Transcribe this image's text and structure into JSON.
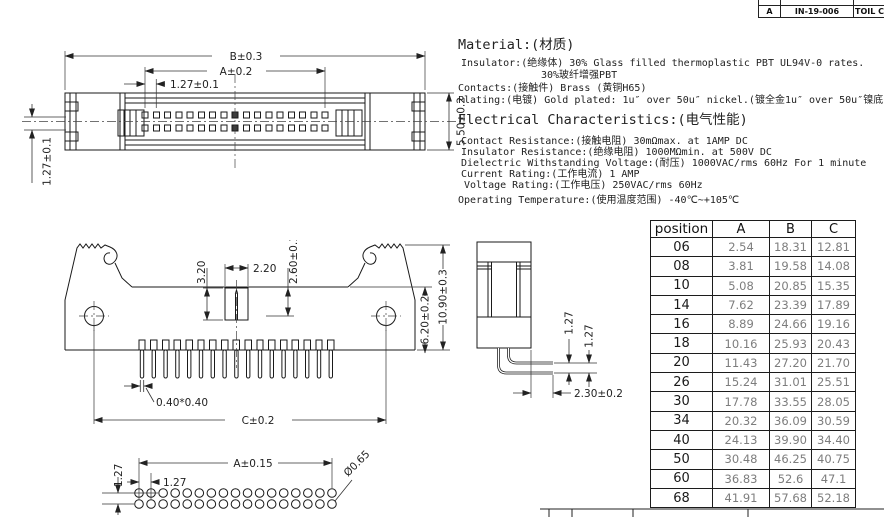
{
  "revision_strip": {
    "rev": "A",
    "code": "IN-19-006",
    "title": "TOIL C"
  },
  "material": {
    "heading": "Material:(材质)",
    "lines": [
      "Insulator:(绝缘体) 30% Glass filled thermoplastic PBT UL94V-0 rates.",
      "30%玻纤增强PBT",
      "Contacts:(接触件) Brass (黄铜H65)",
      "Plating:(电镀) Gold plated: 1u″ over 50u″ nickel.(镀全金1u″ over 50u″镍底)"
    ]
  },
  "electrical": {
    "heading": "Electrical Characteristics:(电气性能)",
    "lines": [
      "Contact Resistance:(接触电阻) 30mΩmax. at 1AMP DC",
      "Insulator Resistance:(绝缘电阻) 1000MΩmin. at 500V DC",
      "Dielectric Withstanding Voltage:(耐压) 1000VAC/rms 60Hz For 1 minute",
      "Current Rating:(工作电流) 1 AMP",
      "Voltage Rating:(工作电压) 250VAC/rms 60Hz",
      "Operating Temperature:(使用温度范围) -40℃~+105℃"
    ]
  },
  "dim_table": {
    "headers": [
      "position",
      "A",
      "B",
      "C"
    ],
    "rows": [
      [
        "06",
        "2.54",
        "18.31",
        "12.81"
      ],
      [
        "08",
        "3.81",
        "19.58",
        "14.08"
      ],
      [
        "10",
        "5.08",
        "20.85",
        "15.35"
      ],
      [
        "14",
        "7.62",
        "23.39",
        "17.89"
      ],
      [
        "16",
        "8.89",
        "24.66",
        "19.16"
      ],
      [
        "18",
        "10.16",
        "25.93",
        "20.43"
      ],
      [
        "20",
        "11.43",
        "27.20",
        "21.70"
      ],
      [
        "26",
        "15.24",
        "31.01",
        "25.51"
      ],
      [
        "30",
        "17.78",
        "33.55",
        "28.05"
      ],
      [
        "34",
        "20.32",
        "36.09",
        "30.59"
      ],
      [
        "40",
        "24.13",
        "39.90",
        "34.40"
      ],
      [
        "50",
        "30.48",
        "46.25",
        "40.75"
      ],
      [
        "60",
        "36.83",
        "52.6",
        "47.1"
      ],
      [
        "68",
        "41.91",
        "57.68",
        "52.18"
      ]
    ]
  },
  "drawings": {
    "top_view": {
      "b": "B±0.3",
      "a": "A±0.2",
      "pitch": "1.27±0.1",
      "height": "5.50±0.2",
      "row": "1.27±0.1"
    },
    "front_view": {
      "key_h": "3.20",
      "key_w": "2.20",
      "slot": "2.60±0.15",
      "mate": "6.20±0.2",
      "total": "10.90±0.3",
      "pin": "0.40*0.40",
      "c": "C±0.2"
    },
    "end_view": {
      "p1": "1.27",
      "p2": "1.27",
      "tail": "2.30±0.2"
    },
    "footprint": {
      "a": "A±0.15",
      "pitch": "1.27",
      "row": "1.27",
      "hole": "Ø0.65"
    }
  },
  "colors": {
    "line": "#1a1a1a",
    "dim_text": "#222222",
    "value_text": "#7d7d7d"
  }
}
